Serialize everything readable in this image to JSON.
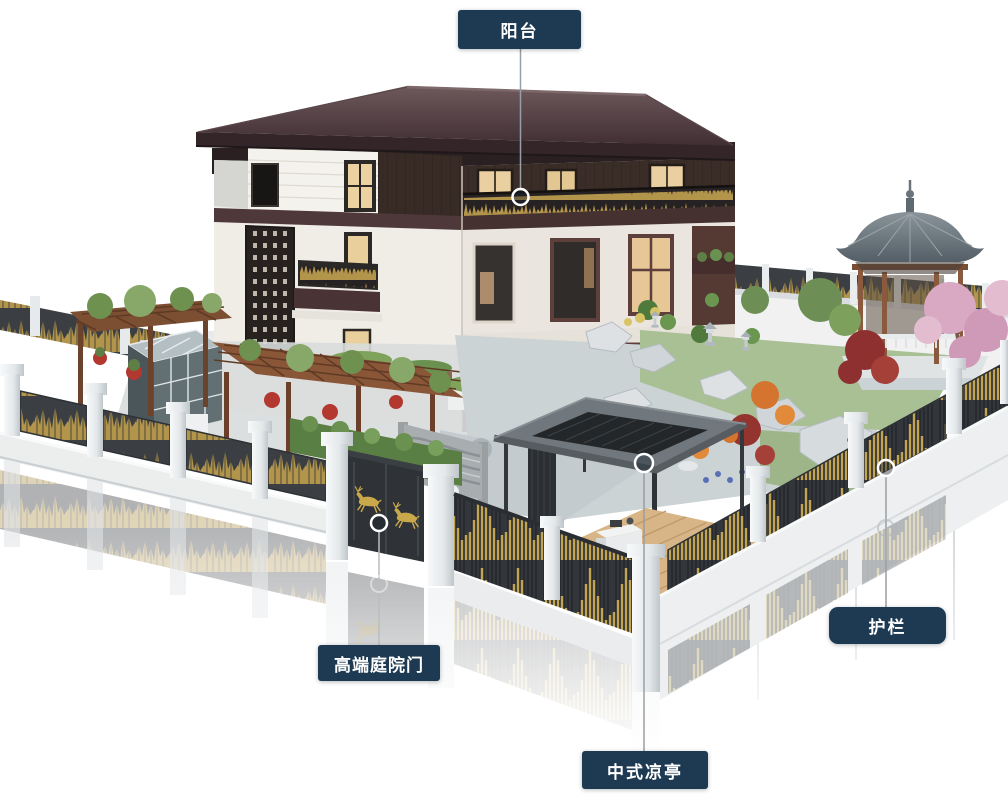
{
  "callouts": {
    "balcony": {
      "label": "阳台"
    },
    "courtyard_gate": {
      "label": "高端庭院门"
    },
    "pavilion": {
      "label": "中式凉亭"
    },
    "guardrail": {
      "label": "护栏"
    }
  },
  "colors": {
    "background": "#ffffff",
    "label_background": "#1d3a52",
    "label_text": "#ffffff",
    "callout_line": "#989fa4",
    "marker_ring": "#ffffff",
    "fence_gold": "#c0a14f",
    "fence_dark": "#3a3e43",
    "fence_stone": "#edeff0",
    "roof_maroon": "#4b3539",
    "pavilion_roof_gray": "#6e7press"
  }
}
